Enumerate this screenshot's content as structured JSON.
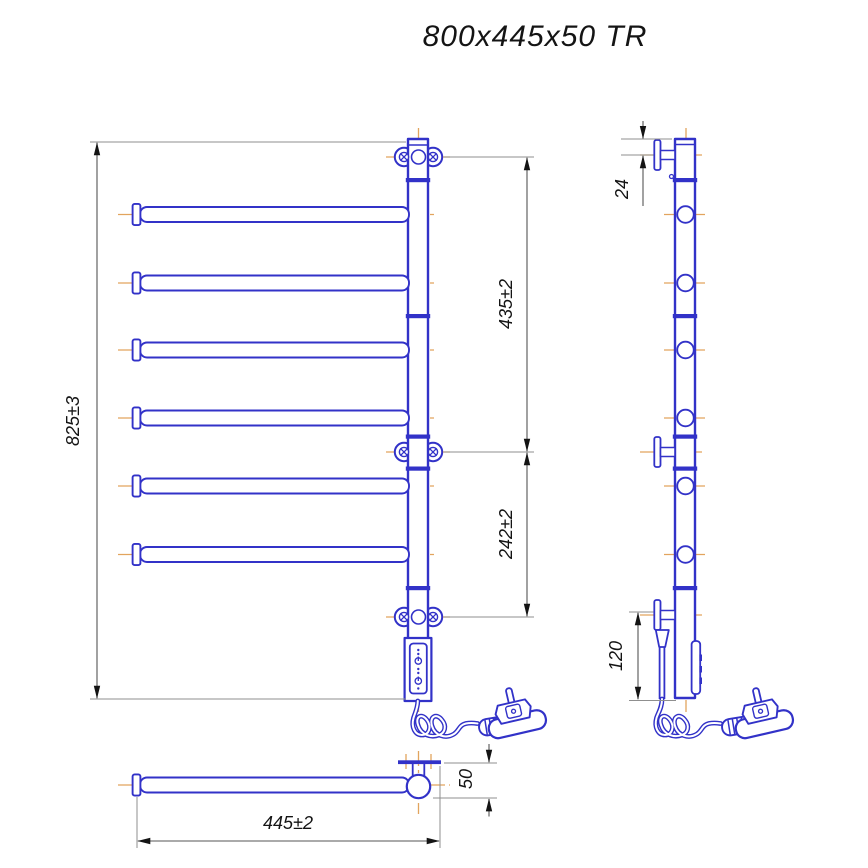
{
  "title": "800x445x50 TR",
  "colors": {
    "line_blue": "#3232c8",
    "centerline_orange": "#e2a45e",
    "dim_gray": "#8f8f8f",
    "arrow_dark": "#141414",
    "text_dark": "#141414",
    "bg": "#ffffff"
  },
  "dimensions": {
    "overall_height": "825±3",
    "upper_bracket_span": "435±2",
    "lower_bracket_span": "242±2",
    "side_top_offset": "24",
    "side_bottom_offset": "120",
    "width": "445±2",
    "depth": "50"
  },
  "structure": {
    "bar_count": 6,
    "wall_bracket_count": 3
  }
}
